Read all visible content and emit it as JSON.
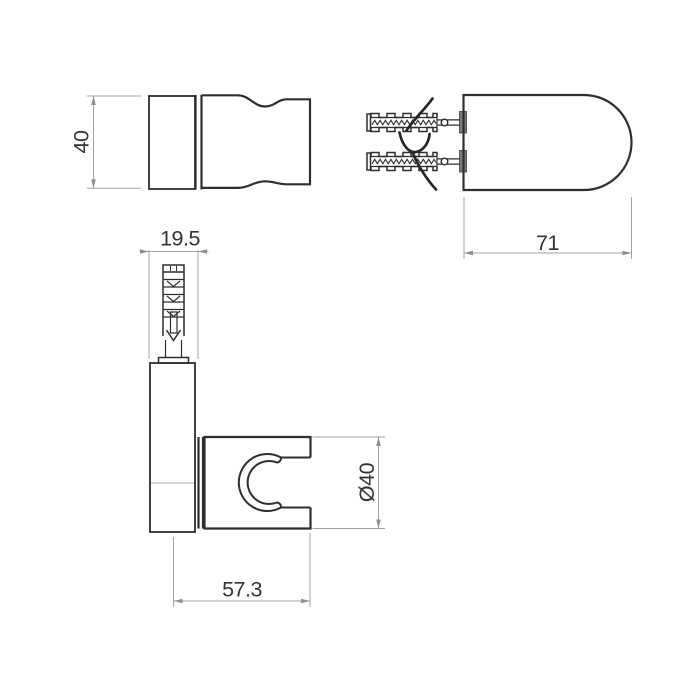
{
  "dimensions": {
    "front_height": "40",
    "plug_width": "19.5",
    "body_depth": "71",
    "holder_diameter": "Ø40",
    "mount_length": "57.3"
  },
  "colors": {
    "outline": "#2e2e2e",
    "dimension_lines": "#a3a3a3",
    "dimension_text": "#333333",
    "background": "#ffffff"
  }
}
